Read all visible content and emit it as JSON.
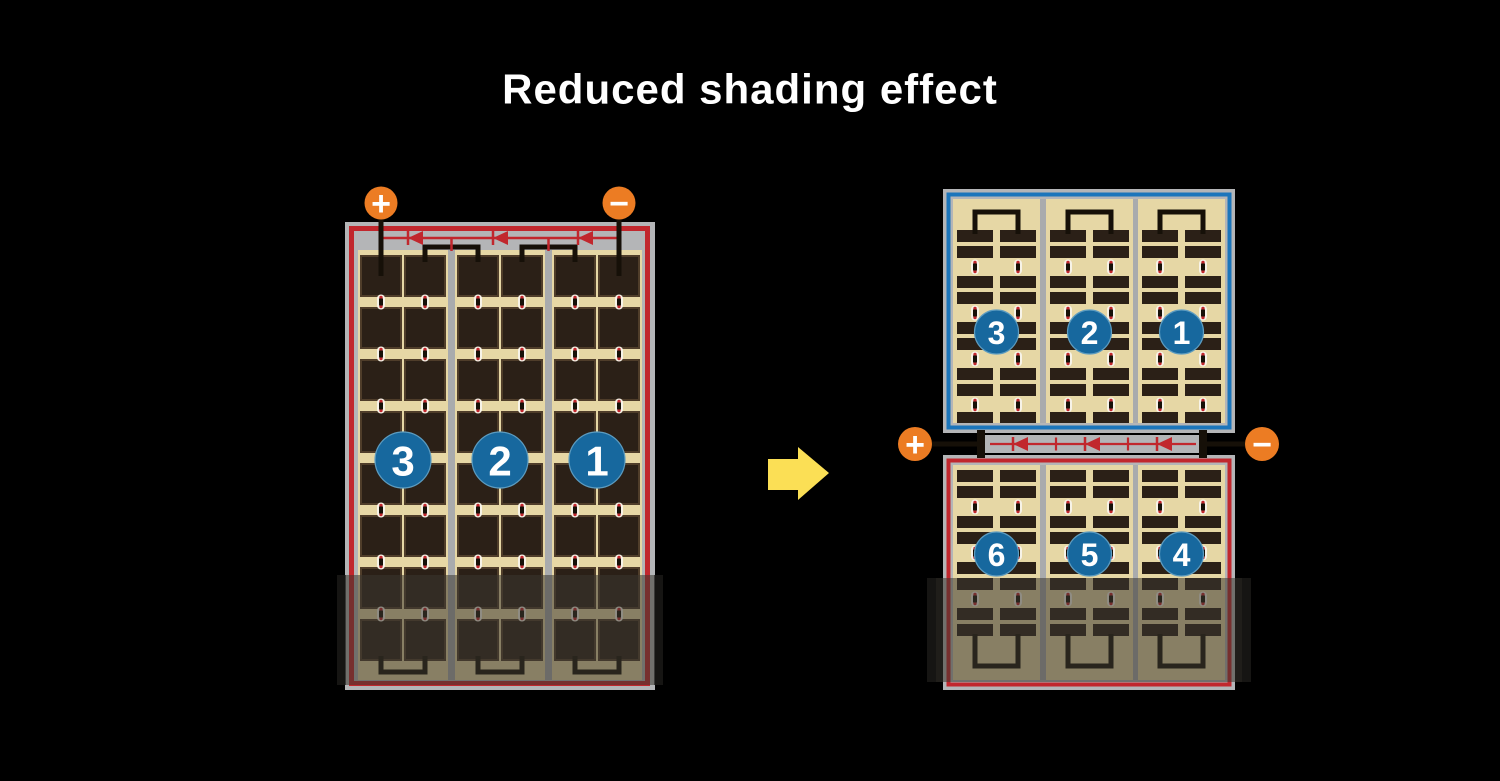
{
  "title": "Reduced shading effect",
  "colors": {
    "background": "#000000",
    "title_text": "#ffffff",
    "frame_gray": "#b4b5b7",
    "divider_gray": "#a9abad",
    "cell_tan": "#e6d7a5",
    "cell_dark": "#2b2017",
    "cell_edge": "#4f3d2a",
    "border_red": "#c1272d",
    "border_blue": "#1b75bb",
    "badge_blue": "#17689e",
    "badge_rim": "#5d9cc0",
    "terminal_orange": "#ec7c23",
    "wire_black": "#161008",
    "bus_gray": "#b3b5b7",
    "diode_red": "#c1272d",
    "dot_white": "#f7f3e8",
    "arrow_yellow": "#fbdf55",
    "shade_overlay": "rgba(58,54,48,0.55)",
    "shade_cap": "rgba(15,15,15,0.55)"
  },
  "icons": {
    "arrow": "right-arrow-icon",
    "plus": "plus-icon",
    "minus": "minus-icon",
    "diode": "bypass-diode-icon"
  },
  "left_module": {
    "terminals": [
      {
        "symbol": "+"
      },
      {
        "symbol": "−"
      }
    ],
    "strings": [
      {
        "label": "3"
      },
      {
        "label": "2"
      },
      {
        "label": "1"
      }
    ],
    "bypass_diodes": 3
  },
  "right_module": {
    "terminals": [
      {
        "symbol": "+"
      },
      {
        "symbol": "−"
      }
    ],
    "top_strings": [
      {
        "label": "3"
      },
      {
        "label": "2"
      },
      {
        "label": "1"
      }
    ],
    "bottom_strings": [
      {
        "label": "6"
      },
      {
        "label": "5"
      },
      {
        "label": "4"
      }
    ],
    "bypass_diodes": 3
  }
}
